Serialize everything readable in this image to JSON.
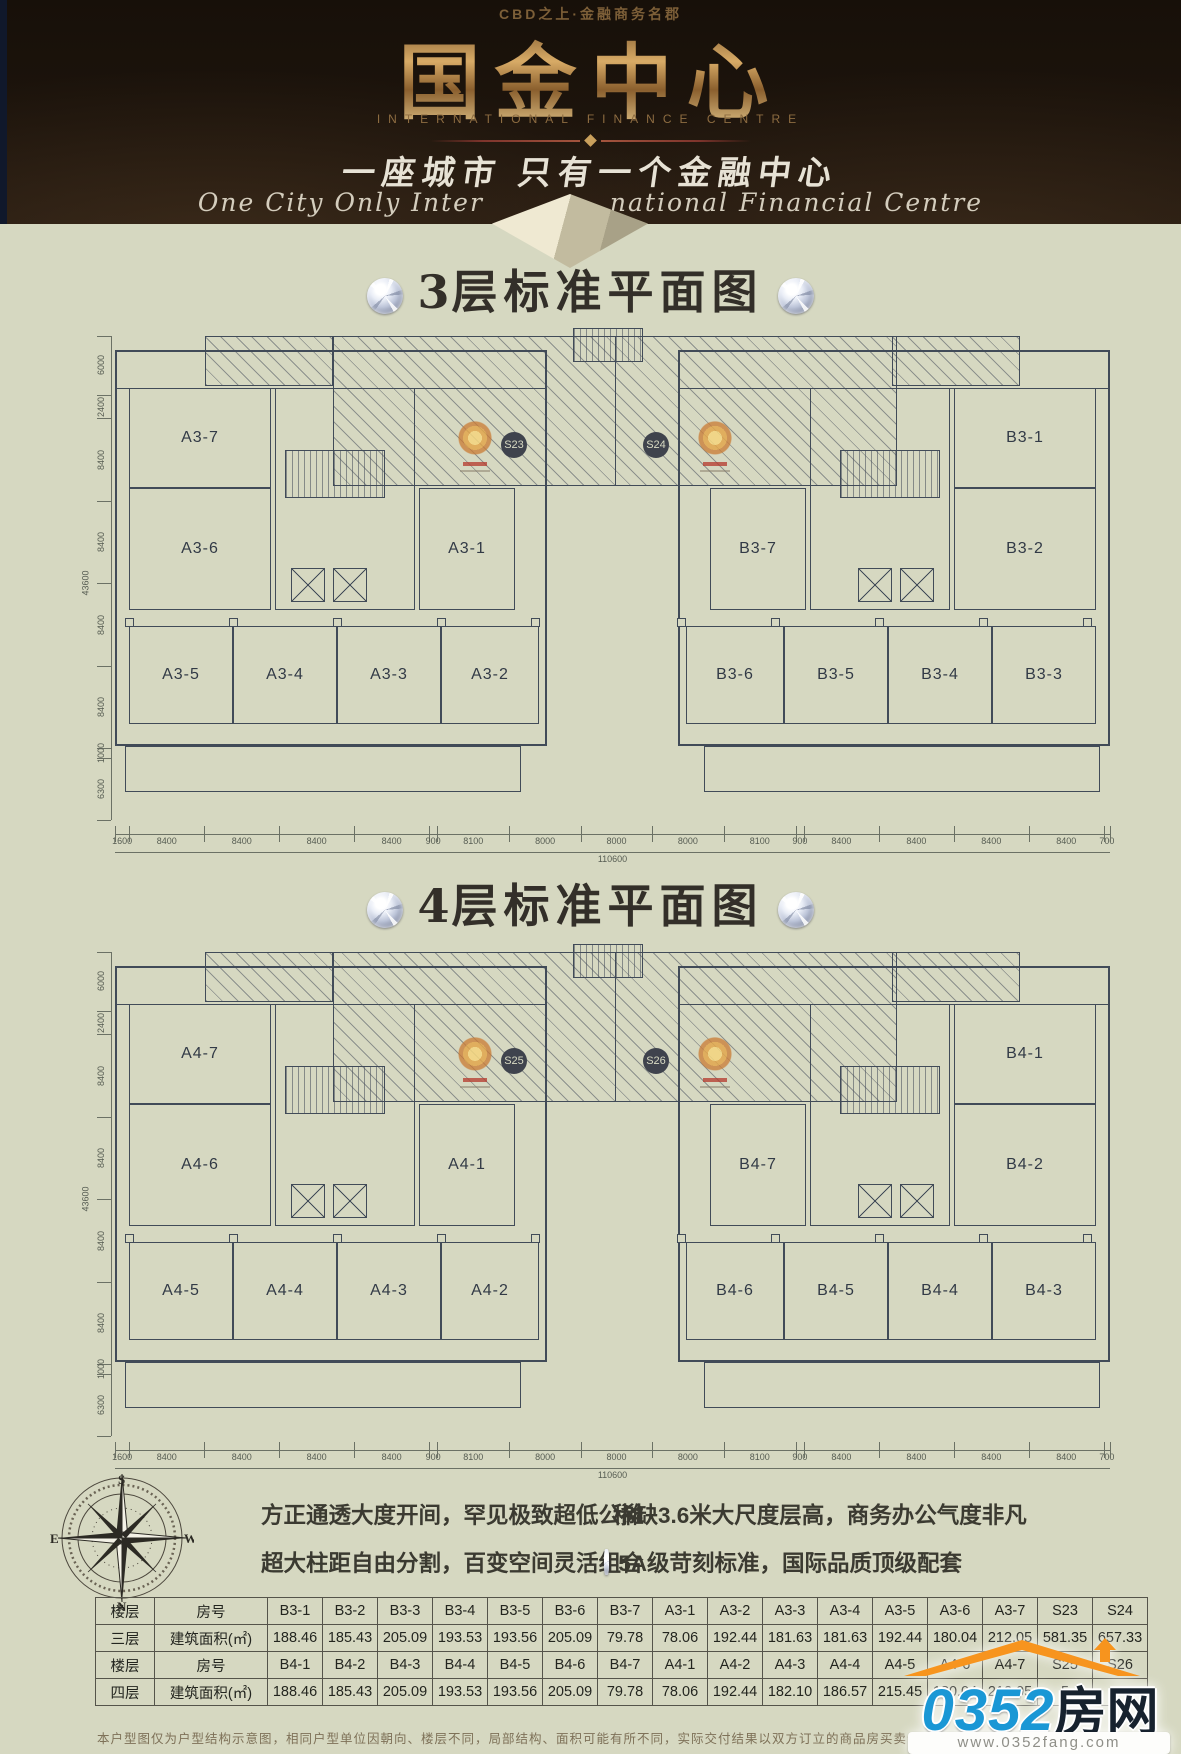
{
  "header": {
    "tagline_top": "CBD之上·金融商务名郡",
    "logo": "国金中心",
    "logo_sub": "INTERNATIONAL FINANCE CENTRE",
    "slogan_cn": "一座城市  只有一个金融中心",
    "slogan_en_left": "One City Only Inter",
    "slogan_en_right": "national Financial Centre"
  },
  "floors": [
    {
      "num": "3",
      "title_rest": "层标准平面图",
      "corridor_marks": [
        "S23",
        "S24"
      ],
      "left_rooms": [
        "A3-7",
        "A3-6",
        "A3-1",
        "A3-5",
        "A3-4",
        "A3-3",
        "A3-2"
      ],
      "right_rooms": [
        "B3-1",
        "B3-2",
        "B3-7",
        "B3-6",
        "B3-5",
        "B3-4",
        "B3-3"
      ],
      "dims": {
        "left": [
          "6000",
          "2400",
          "8400",
          "8400",
          "8400",
          "8400",
          "1000",
          "6300"
        ],
        "left_total": "43600",
        "bottom": [
          "1600",
          "8400",
          "8400",
          "8400",
          "8400",
          "900",
          "8100",
          "8000",
          "8000",
          "8000",
          "8100",
          "900",
          "8400",
          "8400",
          "8400",
          "8400",
          "700"
        ],
        "bottom_total": "110600"
      }
    },
    {
      "num": "4",
      "title_rest": "层标准平面图",
      "corridor_marks": [
        "S25",
        "S26"
      ],
      "left_rooms": [
        "A4-7",
        "A4-6",
        "A4-1",
        "A4-5",
        "A4-4",
        "A4-3",
        "A4-2"
      ],
      "right_rooms": [
        "B4-1",
        "B4-2",
        "B4-7",
        "B4-6",
        "B4-5",
        "B4-4",
        "B4-3"
      ],
      "dims": {
        "left": [
          "6000",
          "2400",
          "8400",
          "8400",
          "8400",
          "8400",
          "1000",
          "6300"
        ],
        "left_total": "43600",
        "bottom": [
          "1600",
          "8400",
          "8400",
          "8400",
          "8400",
          "900",
          "8100",
          "8000",
          "8000",
          "8000",
          "8100",
          "900",
          "8400",
          "8400",
          "8400",
          "8400",
          "700"
        ],
        "bottom_total": "110600"
      }
    }
  ],
  "features": [
    "方正通透大度开间，罕见极致超低公摊",
    "稀缺3.6米大尺度层高，商务办公气度非凡",
    "超大柱距自由分割，百变空间灵活组合",
    "5A级苛刻标准，国际品质顶级配套"
  ],
  "compass": {
    "north": "N",
    "south": "S",
    "east": "E",
    "west": "W"
  },
  "table": {
    "rows": [
      [
        "楼层",
        "房号",
        "B3-1",
        "B3-2",
        "B3-3",
        "B3-4",
        "B3-5",
        "B3-6",
        "B3-7",
        "A3-1",
        "A3-2",
        "A3-3",
        "A3-4",
        "A3-5",
        "A3-6",
        "A3-7",
        "S23",
        "S24"
      ],
      [
        "三层",
        "建筑面积(㎡)",
        "188.46",
        "185.43",
        "205.09",
        "193.53",
        "193.56",
        "205.09",
        "79.78",
        "78.06",
        "192.44",
        "181.63",
        "181.63",
        "192.44",
        "180.04",
        "212.05",
        "581.35",
        "657.33"
      ],
      [
        "楼层",
        "房号",
        "B4-1",
        "B4-2",
        "B4-3",
        "B4-4",
        "B4-5",
        "B4-6",
        "B4-7",
        "A4-1",
        "A4-2",
        "A4-3",
        "A4-4",
        "A4-5",
        "A4-6",
        "A4-7",
        "S25",
        "S26"
      ],
      [
        "四层",
        "建筑面积(㎡)",
        "188.46",
        "185.43",
        "205.09",
        "193.53",
        "193.56",
        "205.09",
        "79.78",
        "78.06",
        "192.44",
        "182.10",
        "186.57",
        "215.45",
        "180.04",
        "212.05",
        "5",
        ""
      ]
    ]
  },
  "site_logo": {
    "brand_number": "0352",
    "brand_name": "房网",
    "website": "www.0352fang.com"
  },
  "disclaimer": "本户型图仅为户型结构示意图，相同户型单位因朝向、楼层不同，局部结构、面积可能有所不同，实际交付结果以双方订立的商品房买卖合同约定为准，开发商保留最终解释权。"
}
